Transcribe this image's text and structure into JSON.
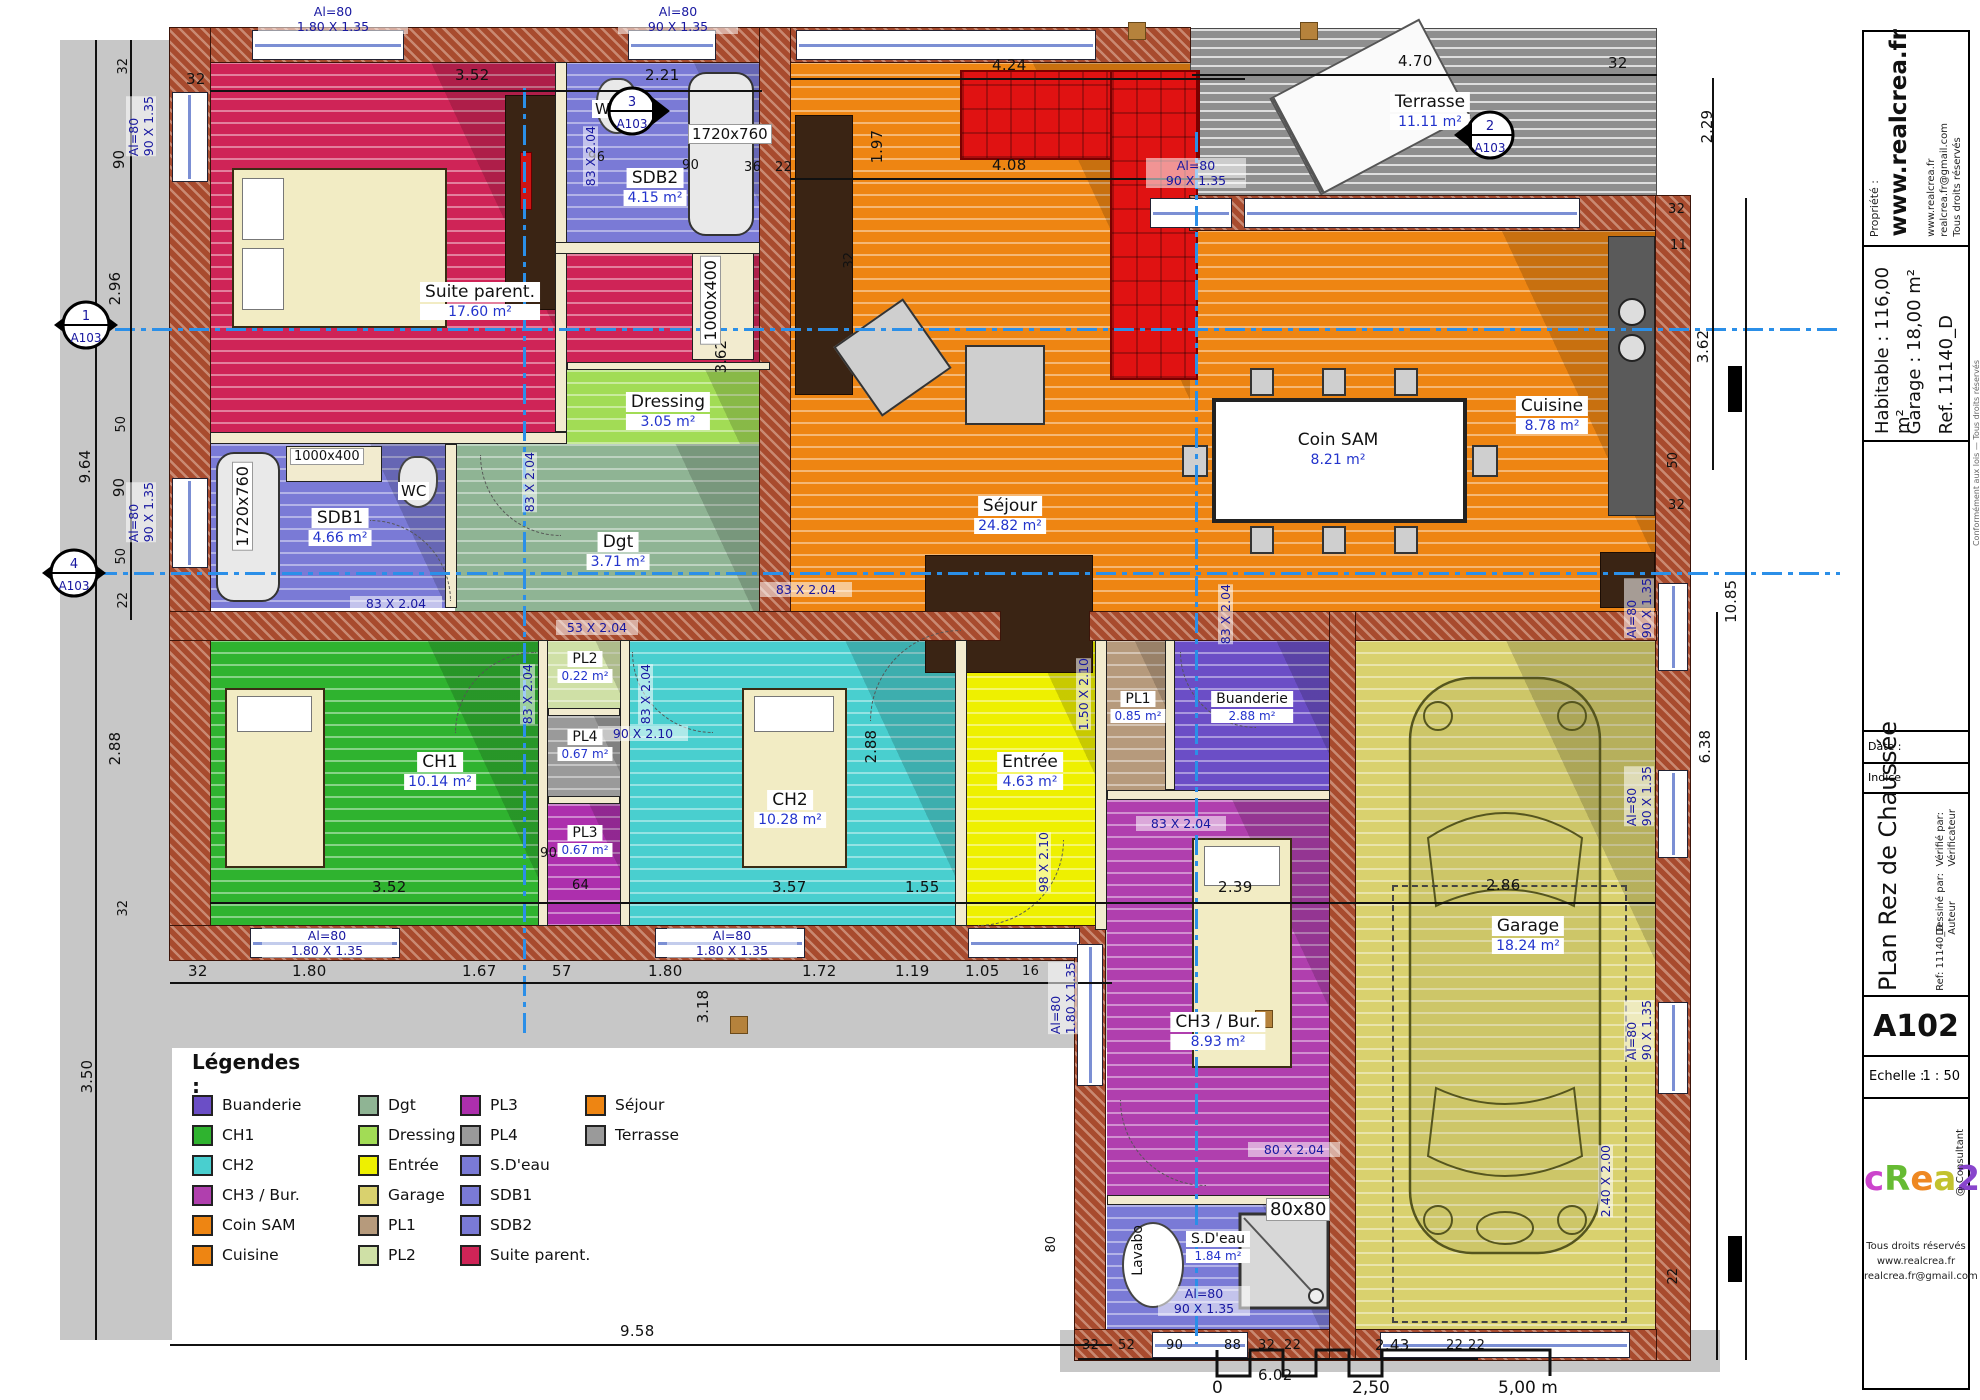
{
  "plan": {
    "drawing_title": "PLan Rez de Chaussée",
    "sheet_number": "A102"
  },
  "legend": {
    "title": "Légendes :",
    "col1": [
      {
        "label": "Buanderie",
        "color": "#6b4ec6"
      },
      {
        "label": "CH1",
        "color": "#2fb32f"
      },
      {
        "label": "CH2",
        "color": "#49cfcf"
      },
      {
        "label": "CH3 / Bur.",
        "color": "#b03fae"
      },
      {
        "label": "Coin SAM",
        "color": "#ee8512"
      },
      {
        "label": "Cuisine",
        "color": "#ee8512"
      }
    ],
    "col2": [
      {
        "label": "Dgt",
        "color": "#8fb494"
      },
      {
        "label": "Dressing",
        "color": "#a2dc55"
      },
      {
        "label": "Entrée",
        "color": "#eef000"
      },
      {
        "label": "Garage",
        "color": "#d9d16e"
      },
      {
        "label": "PL1",
        "color": "#b69a7c"
      },
      {
        "label": "PL2",
        "color": "#cfe0a6"
      }
    ],
    "col3": [
      {
        "label": "PL3",
        "color": "#ad2fad"
      },
      {
        "label": "PL4",
        "color": "#9a9a9a"
      },
      {
        "label": "S.D'eau",
        "color": "#7a7ad6"
      },
      {
        "label": "SDB1",
        "color": "#7a7ad6"
      },
      {
        "label": "SDB2",
        "color": "#7a7ad6"
      },
      {
        "label": "Suite parent.",
        "color": "#cf2457"
      }
    ],
    "col4": [
      {
        "label": "Séjour",
        "color": "#ee8512"
      },
      {
        "label": "Terrasse",
        "color": "#9a9a9a"
      }
    ]
  },
  "rooms": {
    "suite": {
      "name": "Suite parent.",
      "area": "17.60 m²"
    },
    "sdb2": {
      "name": "SDB2",
      "area": "4.15 m²"
    },
    "sdb1": {
      "name": "SDB1",
      "area": "4.66 m²"
    },
    "dressing": {
      "name": "Dressing",
      "area": "3.05 m²"
    },
    "dgt": {
      "name": "Dgt",
      "area": "3.71 m²"
    },
    "sejour": {
      "name": "Séjour",
      "area": "24.82 m²"
    },
    "coinsam": {
      "name": "Coin SAM",
      "area": "8.21 m²"
    },
    "cuisine": {
      "name": "Cuisine",
      "area": "8.78 m²"
    },
    "terrasse": {
      "name": "Terrasse",
      "area": "11.11 m²"
    },
    "ch1": {
      "name": "CH1",
      "area": "10.14 m²"
    },
    "ch2": {
      "name": "CH2",
      "area": "10.28 m²"
    },
    "ch3": {
      "name": "CH3 / Bur.",
      "area": "8.93 m²"
    },
    "entree": {
      "name": "Entrée",
      "area": "4.63 m²"
    },
    "pl1": {
      "name": "PL1",
      "area": "0.85 m²"
    },
    "pl2": {
      "name": "PL2",
      "area": "0.22 m²"
    },
    "pl3": {
      "name": "PL3",
      "area": "0.67 m²"
    },
    "pl4": {
      "name": "PL4",
      "area": "0.67 m²"
    },
    "buanderie": {
      "name": "Buanderie",
      "area": "2.88 m²"
    },
    "sdeau": {
      "name": "S.D'eau",
      "area": "1.84 m²"
    },
    "garage": {
      "name": "Garage",
      "area": "18.24 m²"
    }
  },
  "fixtures": {
    "wc": "WC",
    "lavabo": "Lavabo",
    "shower": "80x80",
    "bath": "1720x760",
    "sink": "1000x400"
  },
  "dims": {
    "d11": "11",
    "d16": "16",
    "d22": "22",
    "d32": "32",
    "d36": "36",
    "d50": "50",
    "d52": "52",
    "d57": "57",
    "d64": "64",
    "d80": "80",
    "d88": "88",
    "d90": "90",
    "d96": "96",
    "d105": "1.05",
    "d119": "1.19",
    "d155": "1.55",
    "d167": "1.67",
    "d172": "1.72",
    "d180": "1.80",
    "d197": "1.97",
    "d221": "2.21",
    "d229": "2.29",
    "d239": "2.39",
    "d243": "2.43",
    "d286": "2.86",
    "d288": "2.88",
    "d296": "2.96",
    "d318": "3.18",
    "d350": "3.50",
    "d352": "3.52",
    "d357": "3.57",
    "d362": "3.62",
    "d408": "4.08",
    "d424": "4.24",
    "d470": "4.70",
    "d602": "6.02",
    "d638": "6.38",
    "d958": "9.58",
    "d964": "9.64",
    "d1085": "10.85"
  },
  "annotations": {
    "al180": "Al=80\n1.80 X 1.35",
    "al90": "Al=80\n90 X 1.35",
    "a83": "83 X 2.04",
    "a53": "53 X 2.04",
    "a9021": "90 X 2.10",
    "a15021": "1.50 X 2.10",
    "a8020": "80 X 2.04",
    "a9821": "98 X 2.10",
    "a240": "2.40 X 2.00"
  },
  "markers": {
    "m1": {
      "n": "1",
      "ref": "A103"
    },
    "m2": {
      "n": "2",
      "ref": "A103"
    },
    "m3": {
      "n": "3",
      "ref": "A103"
    },
    "m4": {
      "n": "4",
      "ref": "A103"
    }
  },
  "title_block": {
    "propriete_label": "Propriété :",
    "site": "www.realcrea.fr",
    "contact": "www.realcrea.fr\nrealcrea.fr@gmail.com\nTous droits réservés",
    "habitable": "Habitable : 116,00 m²",
    "garage": "Garage : 18,00 m²",
    "ref": "Ref. 11140_D",
    "date_label": "Date :",
    "indice_label": "Indice",
    "ref_small": "Ref:  11140_D",
    "drawn_label": "Dessiné par:",
    "author_label": "Auteur",
    "verified_label": "Vérifié par:",
    "verifier_label": "Vérificateur",
    "plan_title": "PLan Rez de Chaussée",
    "sheet": "A102",
    "scale_label": "Echelle :",
    "scale_value": "1 : 50",
    "logo_chars": [
      {
        "ch": "c",
        "color": "#cc44cc"
      },
      {
        "ch": "R",
        "color": "#66bb33"
      },
      {
        "ch": "e",
        "color": "#ee8822"
      },
      {
        "ch": "a",
        "color": "#c2c22e"
      },
      {
        "ch": "2",
        "color": "#8844cc"
      },
      {
        "ch": "l",
        "color": "#44ccdd"
      }
    ],
    "consultant": "@ Consultant",
    "rights": "Tous droits réservés\nwww.realcrea.fr\nrealcrea.fr@gmail.com",
    "fine_print": "Conformément aux lois — Tous droits réservés"
  },
  "scale_bar": {
    "start": "0",
    "mid": "2,50",
    "end": "5,00 m"
  }
}
